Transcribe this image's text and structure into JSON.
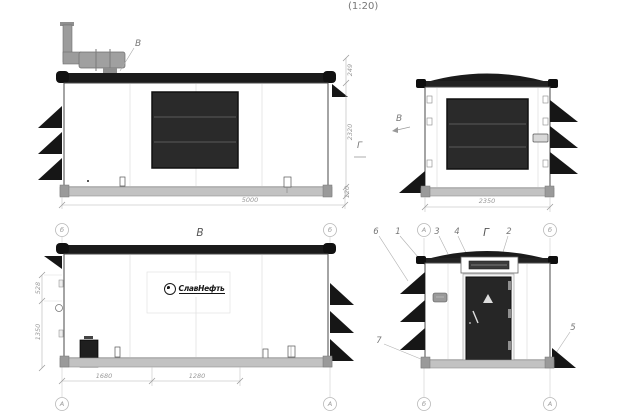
{
  "drawing": {
    "scale_note": "(1:20)"
  },
  "colors": {
    "roof_dark": "#1b1b1b",
    "louver_panel_dark": "#2a2a2a",
    "base_gray": "#c2c2c2",
    "exhaust_gray": "#9c9c9c",
    "annotation_gray": "#999999"
  },
  "view_side_a": {
    "exhaust_callout": "В",
    "section_mark": "Г",
    "dim_width": "5000",
    "dim_roof_height": "249",
    "dim_body_height": "2320",
    "dim_base_height": "120"
  },
  "view_end_rear": {
    "view_direction_label": "В",
    "dim_width": "2350"
  },
  "view_side_b": {
    "title": "В",
    "logo_text": "СлавНефть",
    "dim_upper": "528",
    "dim_lower": "1350",
    "dim_bottom_first": "1680",
    "dim_bottom_second": "1280",
    "grid_top_left": "б",
    "grid_top_right": "б",
    "grid_bottom_left": "А",
    "grid_bottom_right": "А"
  },
  "view_end_door": {
    "title": "Г",
    "grid_top_left": "А",
    "grid_top_right": "б",
    "grid_bottom_left": "б",
    "grid_bottom_right": "А",
    "callout_1": "1",
    "callout_2": "2",
    "callout_3": "3",
    "callout_4": "4",
    "callout_5": "5",
    "callout_6": "6",
    "callout_7": "7"
  }
}
